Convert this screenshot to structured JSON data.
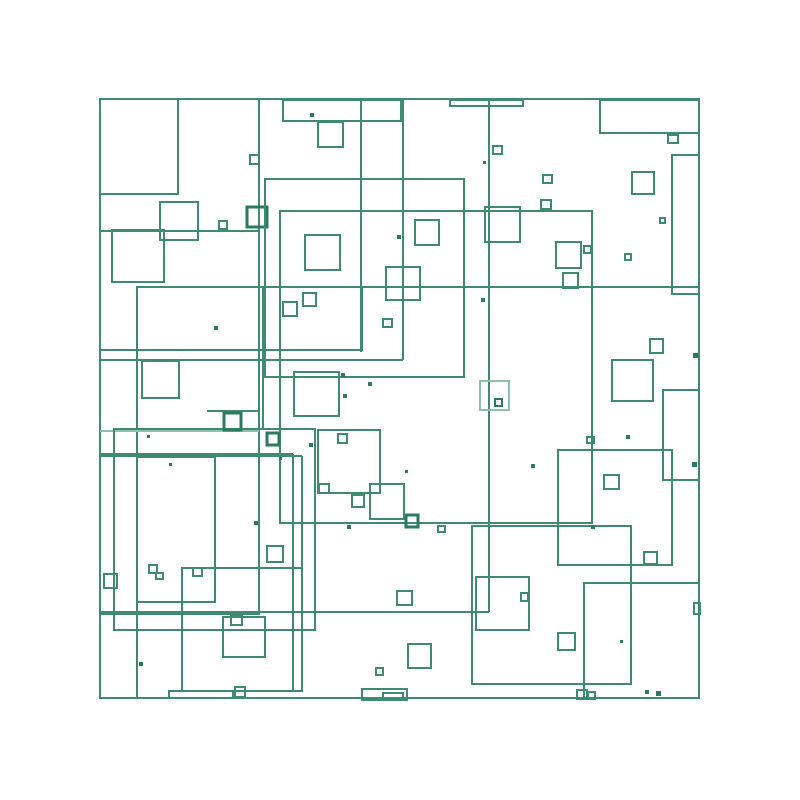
{
  "artwork": {
    "description": "Abstract generative artwork of overlapping outlined teal squares on a white background",
    "canvas": {
      "width": 800,
      "height": 800,
      "background": "#ffffff"
    },
    "palette": {
      "background": "#ffffff",
      "stroke_mid": "#3E8A73",
      "stroke_dark": "#2C7A62",
      "stroke_light": "#8FC0AE"
    },
    "border": {
      "x": 100,
      "y": 99,
      "w": 599,
      "h": 599,
      "shade": "m",
      "sw": 2
    },
    "squares": [
      [
        100,
        99,
        78,
        95,
        "m",
        2
      ],
      [
        283,
        100,
        118,
        21,
        "m",
        2
      ],
      [
        318,
        122,
        25,
        25,
        "m",
        2
      ],
      [
        450,
        100,
        73,
        6,
        "m",
        2
      ],
      [
        600,
        100,
        99,
        33,
        "m",
        2
      ],
      [
        672,
        155,
        27,
        139,
        "m",
        2
      ],
      [
        160,
        202,
        38,
        38,
        "m",
        2
      ],
      [
        112,
        230,
        52,
        52,
        "m",
        2
      ],
      [
        247,
        207,
        20,
        20,
        "d",
        3
      ],
      [
        265,
        179,
        199,
        198,
        "m",
        2
      ],
      [
        280,
        211,
        312,
        312,
        "m",
        2
      ],
      [
        137,
        287,
        225,
        63,
        "m",
        2
      ],
      [
        142,
        361,
        37,
        37,
        "m",
        2
      ],
      [
        114,
        429,
        201,
        201,
        "m",
        2
      ],
      [
        137,
        457,
        78,
        145,
        "m",
        2
      ],
      [
        182,
        568,
        120,
        123,
        "m",
        2
      ],
      [
        223,
        617,
        42,
        40,
        "m",
        2
      ],
      [
        169,
        691,
        64,
        7,
        "m",
        2
      ],
      [
        362,
        689,
        45,
        11,
        "m",
        2
      ],
      [
        383,
        693,
        20,
        7,
        "m",
        2
      ],
      [
        472,
        526,
        159,
        158,
        "m",
        2
      ],
      [
        558,
        450,
        114,
        115,
        "m",
        2
      ],
      [
        584,
        583,
        115,
        115,
        "m",
        2
      ],
      [
        663,
        390,
        36,
        90,
        "m",
        2
      ],
      [
        476,
        577,
        53,
        53,
        "m",
        2
      ],
      [
        370,
        484,
        34,
        35,
        "m",
        2
      ],
      [
        318,
        430,
        62,
        63,
        "m",
        2
      ],
      [
        294,
        372,
        45,
        44,
        "m",
        2
      ],
      [
        386,
        267,
        34,
        33,
        "m",
        2
      ],
      [
        305,
        235,
        35,
        35,
        "m",
        2
      ],
      [
        415,
        220,
        24,
        25,
        "m",
        2
      ],
      [
        480,
        381,
        29,
        29,
        "l",
        2
      ],
      [
        485,
        207,
        35,
        35,
        "m",
        2
      ],
      [
        612,
        360,
        41,
        41,
        "m",
        2
      ],
      [
        556,
        242,
        25,
        26,
        "m",
        2
      ],
      [
        563,
        273,
        15,
        15,
        "m",
        2
      ],
      [
        632,
        172,
        22,
        22,
        "m",
        2
      ],
      [
        650,
        339,
        13,
        14,
        "m",
        2
      ],
      [
        644,
        552,
        13,
        12,
        "m",
        2
      ],
      [
        604,
        475,
        15,
        14,
        "m",
        2
      ],
      [
        558,
        633,
        17,
        17,
        "m",
        2
      ],
      [
        397,
        591,
        15,
        14,
        "m",
        2
      ],
      [
        408,
        644,
        23,
        24,
        "m",
        2
      ],
      [
        267,
        546,
        16,
        16,
        "m",
        2
      ],
      [
        104,
        574,
        13,
        14,
        "m",
        2
      ],
      [
        224,
        413,
        17,
        17,
        "d",
        3
      ],
      [
        267,
        433,
        12,
        12,
        "d",
        3
      ],
      [
        406,
        515,
        12,
        12,
        "d",
        3
      ],
      [
        352,
        495,
        12,
        12,
        "m",
        2
      ],
      [
        250,
        155,
        9,
        9,
        "m",
        2
      ],
      [
        219,
        221,
        8,
        8,
        "m",
        2
      ],
      [
        493,
        146,
        9,
        8,
        "m",
        2
      ],
      [
        543,
        175,
        9,
        8,
        "m",
        2
      ],
      [
        541,
        200,
        10,
        9,
        "m",
        2
      ],
      [
        383,
        319,
        9,
        8,
        "m",
        2
      ],
      [
        338,
        434,
        9,
        9,
        "m",
        2
      ],
      [
        319,
        484,
        10,
        9,
        "m",
        2
      ],
      [
        521,
        593,
        7,
        8,
        "m",
        2
      ],
      [
        495,
        399,
        7,
        7,
        "d",
        2
      ],
      [
        587,
        437,
        7,
        6,
        "m",
        2
      ],
      [
        584,
        246,
        7,
        7,
        "m",
        2
      ],
      [
        660,
        218,
        5,
        5,
        "m",
        2
      ],
      [
        625,
        254,
        6,
        6,
        "m",
        2
      ],
      [
        668,
        135,
        10,
        8,
        "m",
        2
      ],
      [
        283,
        302,
        14,
        14,
        "m",
        2
      ],
      [
        303,
        293,
        13,
        13,
        "m",
        2
      ],
      [
        231,
        616,
        11,
        9,
        "m",
        2
      ],
      [
        235,
        687,
        10,
        10,
        "m",
        2
      ],
      [
        149,
        565,
        8,
        8,
        "m",
        2
      ],
      [
        156,
        573,
        7,
        6,
        "m",
        2
      ],
      [
        193,
        568,
        9,
        8,
        "m",
        2
      ],
      [
        438,
        526,
        7,
        6,
        "m",
        2
      ],
      [
        577,
        690,
        10,
        9,
        "m",
        2
      ],
      [
        588,
        692,
        7,
        7,
        "m",
        2
      ],
      [
        694,
        603,
        6,
        11,
        "m",
        2
      ],
      [
        376,
        668,
        7,
        7,
        "m",
        2
      ]
    ],
    "segments": [
      [
        "v",
        259,
        99,
        613,
        "m"
      ],
      [
        "v",
        263,
        287,
        430,
        "m"
      ],
      [
        "v",
        137,
        287,
        697,
        "m"
      ],
      [
        "v",
        361,
        99,
        352,
        "m"
      ],
      [
        "h",
        350,
        100,
        362,
        "m"
      ],
      [
        "v",
        403,
        99,
        360,
        "m"
      ],
      [
        "h",
        360,
        100,
        403,
        "m"
      ],
      [
        "v",
        489,
        99,
        612,
        "m"
      ],
      [
        "h",
        287,
        137,
        699,
        "m"
      ],
      [
        "h",
        612,
        100,
        489,
        "m"
      ],
      [
        "h",
        614,
        100,
        260,
        "m"
      ],
      [
        "h",
        454,
        100,
        293,
        "m"
      ],
      [
        "v",
        293,
        454,
        691,
        "m"
      ],
      [
        "h",
        456,
        100,
        302,
        "m"
      ],
      [
        "v",
        302,
        456,
        691,
        "m"
      ],
      [
        "h",
        431,
        100,
        259,
        "l"
      ],
      [
        "h",
        411,
        207,
        259,
        "m"
      ],
      [
        "h",
        231,
        100,
        259,
        "m"
      ]
    ],
    "dots": [
      [
        310,
        113,
        4
      ],
      [
        483,
        161,
        3
      ],
      [
        147,
        435,
        3
      ],
      [
        169,
        463,
        3
      ],
      [
        214,
        326,
        4
      ],
      [
        397,
        235,
        4
      ],
      [
        341,
        373,
        4
      ],
      [
        368,
        382,
        4
      ],
      [
        343,
        394,
        4
      ],
      [
        481,
        298,
        4
      ],
      [
        309,
        443,
        4
      ],
      [
        279,
        457,
        3
      ],
      [
        254,
        521,
        4
      ],
      [
        347,
        525,
        4
      ],
      [
        531,
        464,
        4
      ],
      [
        591,
        525,
        4
      ],
      [
        626,
        435,
        4
      ],
      [
        693,
        353,
        5
      ],
      [
        692,
        462,
        5
      ],
      [
        620,
        640,
        3
      ],
      [
        645,
        690,
        4
      ],
      [
        656,
        691,
        5
      ],
      [
        139,
        662,
        4
      ],
      [
        405,
        470,
        3
      ]
    ]
  }
}
